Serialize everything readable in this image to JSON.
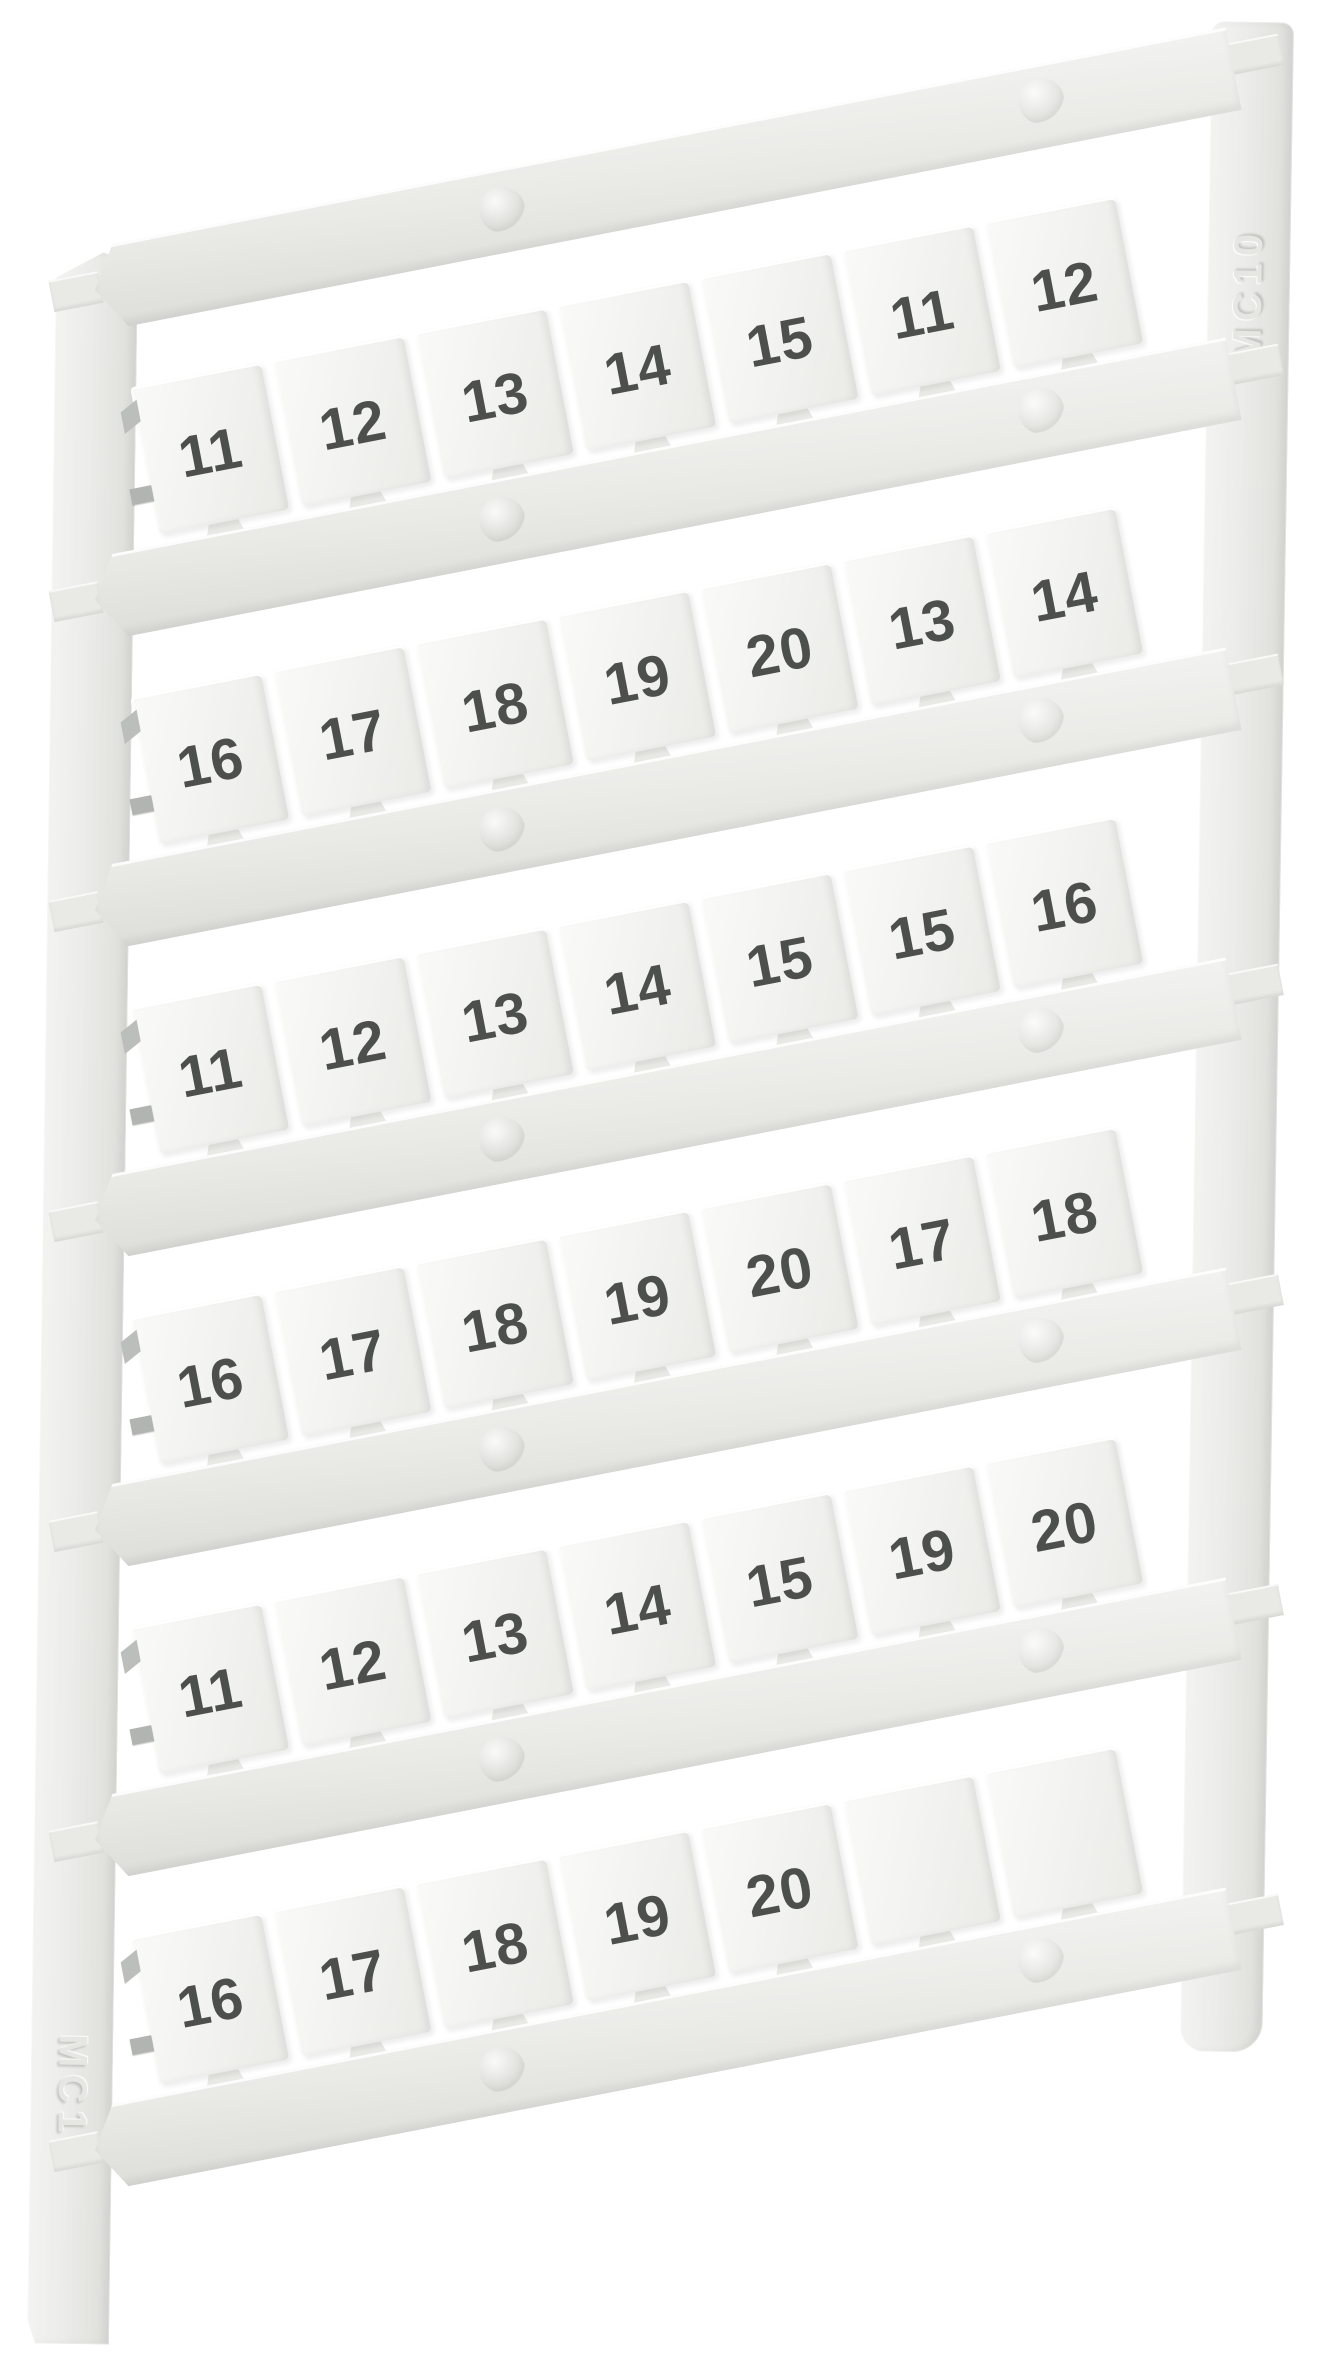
{
  "product": {
    "rails": {
      "left_label": "MC10",
      "right_label": "MC10"
    },
    "rows": [
      {
        "tags": [
          "11",
          "12",
          "13",
          "14",
          "15",
          "11",
          "12"
        ]
      },
      {
        "tags": [
          "16",
          "17",
          "18",
          "19",
          "20",
          "13",
          "14"
        ]
      },
      {
        "tags": [
          "11",
          "12",
          "13",
          "14",
          "15",
          "15",
          "16"
        ]
      },
      {
        "tags": [
          "16",
          "17",
          "18",
          "19",
          "20",
          "17",
          "18"
        ]
      },
      {
        "tags": [
          "11",
          "12",
          "13",
          "14",
          "15",
          "19",
          "20"
        ]
      },
      {
        "tags": [
          "16",
          "17",
          "18",
          "19",
          "20",
          "",
          ""
        ]
      }
    ]
  },
  "colors": {
    "background": "#ffffff",
    "plastic": "#ececea",
    "plastic_shadow": "#dcdcd9",
    "tag_face": "#f3f3f1",
    "digit": "#4d4f4c",
    "sprue_stub": "#b2b4b2",
    "emboss": "#e6e6e3"
  }
}
